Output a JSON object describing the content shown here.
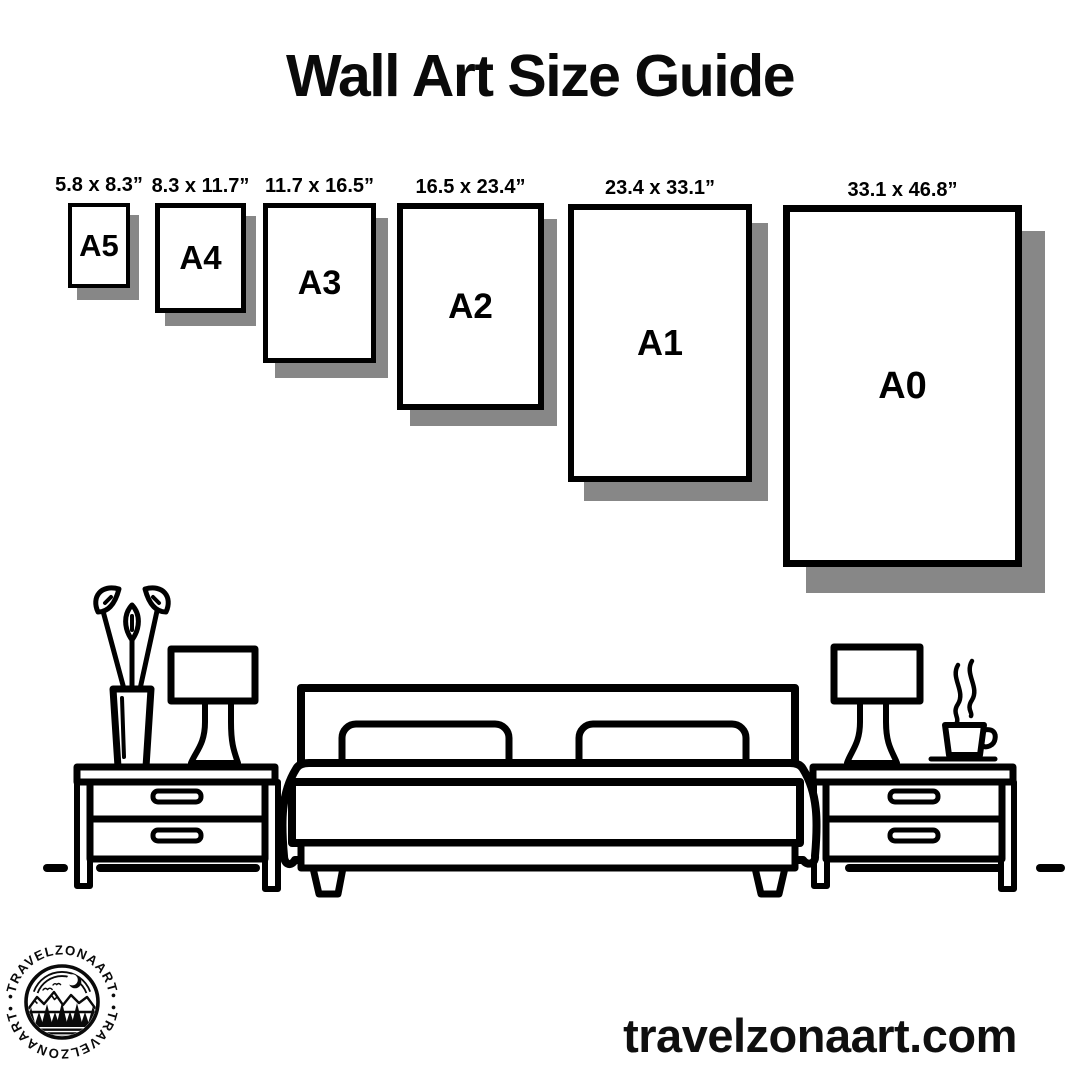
{
  "title": "Wall Art Size Guide",
  "website": "travelzonaart.com",
  "logo": {
    "brand": "TRAVELZONAART",
    "arc_text": "•TRAVELZONAART•"
  },
  "colors": {
    "ink": "#000000",
    "background": "#ffffff",
    "shadow": "#878787"
  },
  "sizes": [
    {
      "code": "A5",
      "dimensions": "5.8 x 8.3”",
      "box": {
        "x": 68,
        "y": 203,
        "w": 62,
        "h": 85,
        "border": 4,
        "shadow": 9,
        "code_px": 31
      }
    },
    {
      "code": "A4",
      "dimensions": "8.3 x 11.7”",
      "box": {
        "x": 155,
        "y": 203,
        "w": 91,
        "h": 110,
        "border": 5,
        "shadow": 10,
        "code_px": 33
      }
    },
    {
      "code": "A3",
      "dimensions": "11.7 x 16.5”",
      "box": {
        "x": 263,
        "y": 203,
        "w": 113,
        "h": 160,
        "border": 5,
        "shadow": 12,
        "code_px": 34
      }
    },
    {
      "code": "A2",
      "dimensions": "16.5 x 23.4”",
      "box": {
        "x": 397,
        "y": 203,
        "w": 147,
        "h": 207,
        "border": 6,
        "shadow": 13,
        "code_px": 35
      }
    },
    {
      "code": "A1",
      "dimensions": "23.4 x 33.1”",
      "box": {
        "x": 568,
        "y": 204,
        "w": 184,
        "h": 278,
        "border": 6,
        "shadow": 16,
        "code_px": 36
      }
    },
    {
      "code": "A0",
      "dimensions": "33.1 x 46.8”",
      "box": {
        "x": 783,
        "y": 205,
        "w": 239,
        "h": 362,
        "border": 7,
        "shadow": 23,
        "code_px": 38
      }
    }
  ]
}
